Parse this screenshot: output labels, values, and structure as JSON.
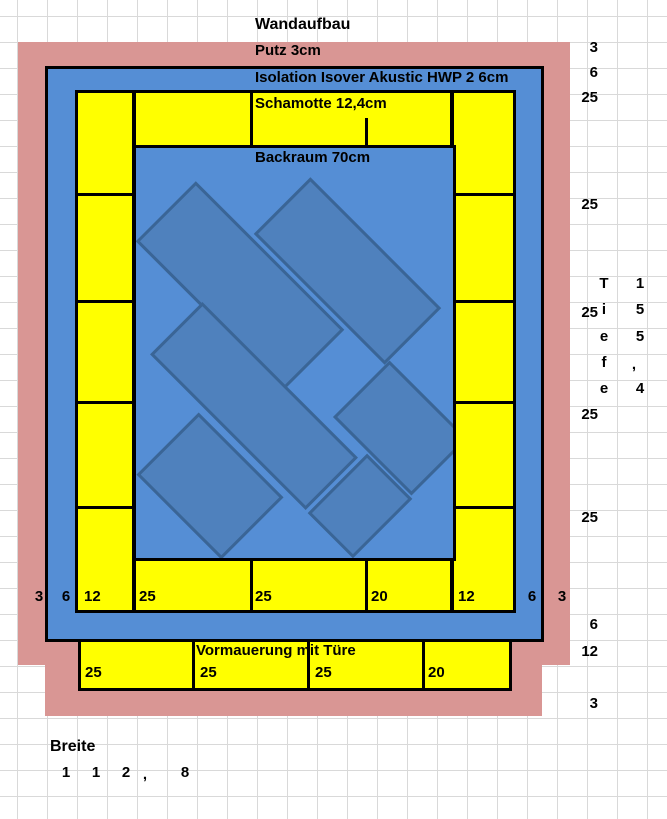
{
  "title": "Wandaufbau",
  "labels": {
    "putz": "Putz 3cm",
    "isolation": "Isolation Isover Akustic HWP 2 6cm",
    "schamotte": "Schamotte 12,4cm",
    "backraum": "Backraum 70cm",
    "vormauerung": "Vormauerung mit Türe",
    "breite": "Breite"
  },
  "bottom_row": [
    "3",
    "6",
    "12",
    "25",
    "25",
    "20",
    "12",
    "6",
    "3"
  ],
  "right_col": [
    "3",
    "6",
    "25",
    "25",
    "25",
    "25",
    "25",
    "6",
    "12",
    "3"
  ],
  "vormauerung_row": [
    "25",
    "25",
    "25",
    "20"
  ],
  "tiefe": {
    "letters": [
      "T",
      "i",
      "e",
      "f",
      "e"
    ],
    "digits": [
      "1",
      "5",
      "5",
      ",",
      "4"
    ],
    "value": "Tiefe 155,4"
  },
  "breite_digits": [
    "1",
    "1",
    "2",
    ",",
    "8"
  ],
  "breite_value": "112,8",
  "colors": {
    "putz_pink": "#d99694",
    "isolation_blue": "#558ed5",
    "schamotte_yellow": "#ffff00",
    "oven_brick_fill": "#4f81bd",
    "oven_brick_border": "#3a6596",
    "outline_black": "#000000"
  }
}
